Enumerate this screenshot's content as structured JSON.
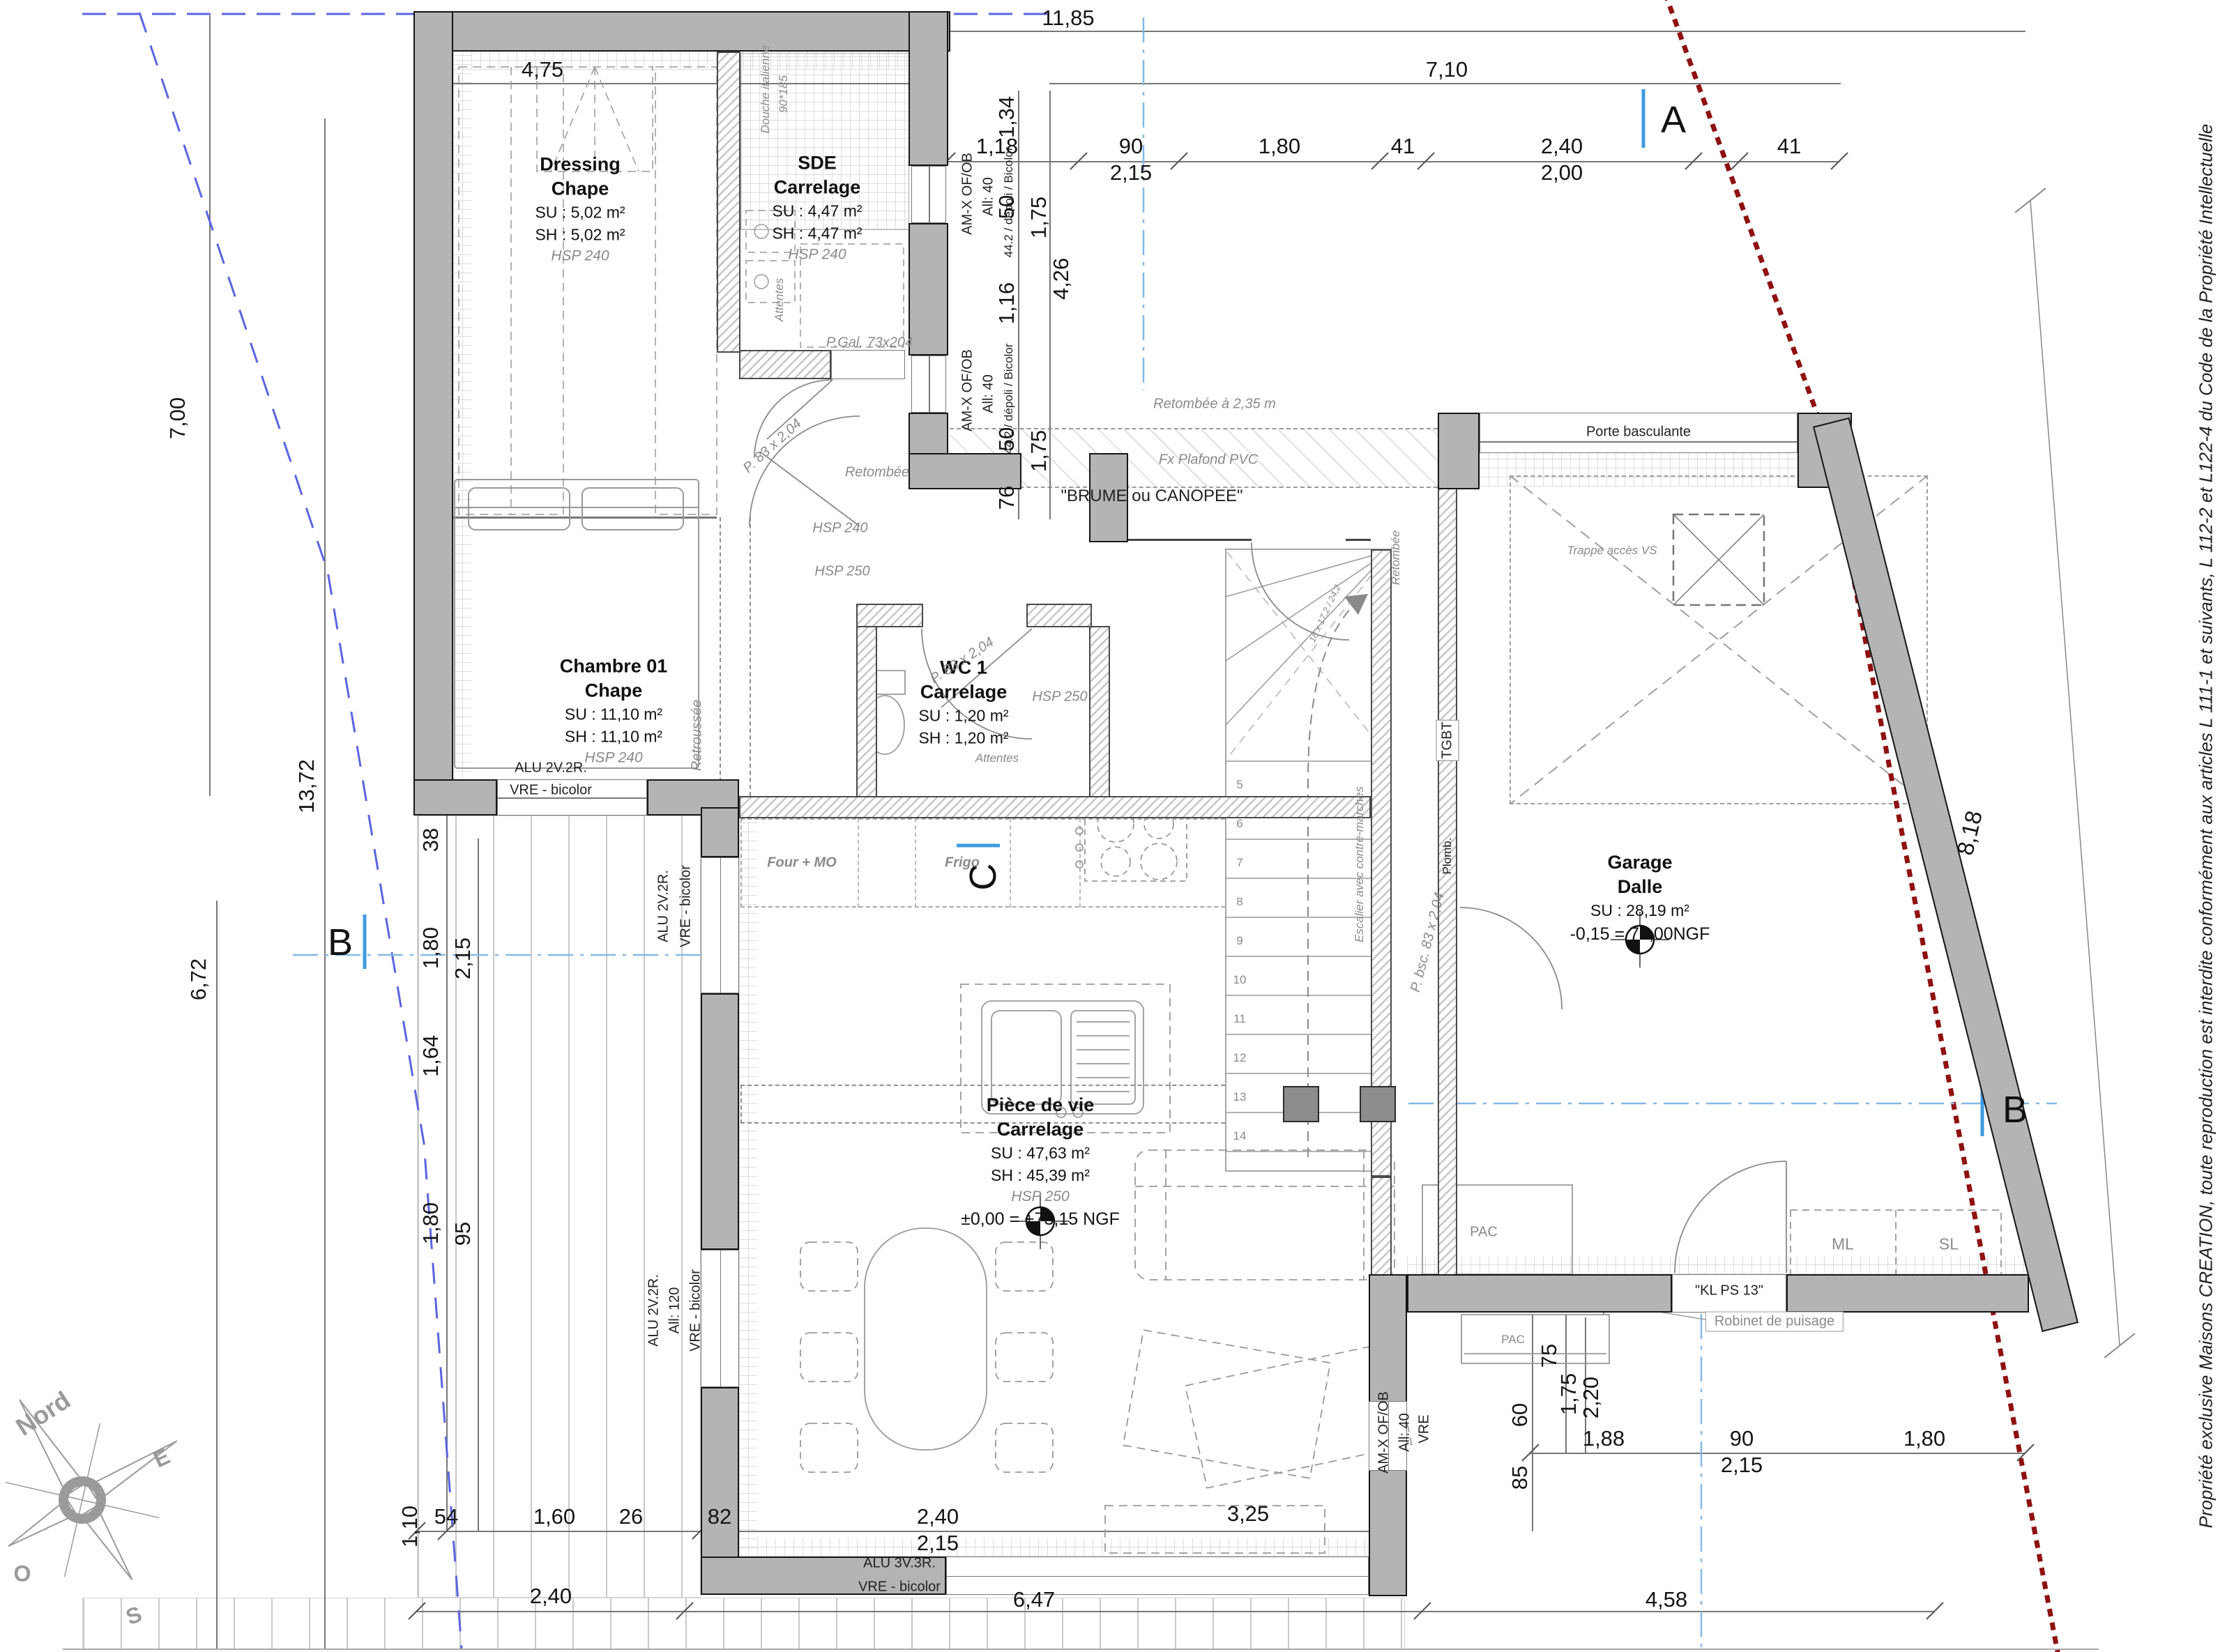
{
  "plan": {
    "copyright": "Propriété exclusive Maisons CREATION, toute reproduction est interdite conformément aux articles L 111-1 et suivants, L 112-2 et L122-4 du Code de la Propriété Intellectuelle",
    "markers": {
      "a": "A",
      "b": "B",
      "c": "C"
    },
    "compass": {
      "n": "Nord",
      "e": "E",
      "o": "O",
      "s": "S"
    },
    "rooms": {
      "dressing": {
        "name": "Dressing",
        "finish": "Chape",
        "su": "SU : 5,02 m²",
        "sh": "SH : 5,02 m²",
        "hsp": "HSP 240"
      },
      "sde": {
        "name": "SDE",
        "finish": "Carrelage",
        "su": "SU : 4,47 m²",
        "sh": "SH : 4,47 m²",
        "hsp": "HSP 240"
      },
      "chambre": {
        "name": "Chambre 01",
        "finish": "Chape",
        "su": "SU : 11,10 m²",
        "sh": "SH : 11,10 m²",
        "hsp": "HSP 240"
      },
      "wc": {
        "name": "WC 1",
        "finish": "Carrelage",
        "su": "SU : 1,20 m²",
        "sh": "SH : 1,20 m²",
        "hsp": "HSP 250"
      },
      "piece": {
        "name": "Pièce de vie",
        "finish": "Carrelage",
        "su": "SU : 47,63 m²",
        "sh": "SH : 45,39 m²",
        "hsp": "HSP 250",
        "level": "±0,00 = +73,15 NGF"
      },
      "garage": {
        "name": "Garage",
        "finish": "Dalle",
        "su": "SU : 28,19 m²",
        "level": "-0,15 = 73,00NGF"
      }
    },
    "ann": {
      "douche1": "Douche italienne",
      "douche2": "90*185",
      "attentes": "Attentes",
      "retroussee": "Retroussée",
      "pgal": "P.Gal. 73x204",
      "p83": "P. 83 x 2,04",
      "pbsc": "P. bsc. 83 x 2,04",
      "amx": "AM-X OF/OB",
      "all40": "All: 40",
      "depoli": "44.2 / dépoli / Bicolor",
      "vre": "VRE",
      "alu2": "ALU 2V.2R.",
      "vrebic": "VRE - bicolor",
      "all120": "All: 120",
      "alu3": "ALU 3V.3R.",
      "retombee": "Retombée",
      "retombee235": "Retombée à 2,35 m",
      "fxplafond": "Fx Plafond PVC",
      "brume": "\"BRUME ou CANOPEE\"",
      "hsp240": "HSP 240",
      "hsp250": "HSP 250",
      "porte_basc": "Porte basculante",
      "trappe": "Trappe accès VS",
      "tgbt": "TGBT",
      "plomb": "Plomb.",
      "escalier": "Escalier avec contre-marches",
      "stair_note": "18 x 17,2 / 24,2",
      "stair_nums": "5\n6\n7\n8\n9\n10\n11\n12\n13\n14",
      "four": "Four + MO",
      "frigo": "Frigo",
      "pac": "PAC",
      "ml": "ML",
      "sl": "SL",
      "klps": "\"KL PS 13\"",
      "robinet": "Robinet de puisage"
    },
    "dims": {
      "t1185": "11,85",
      "t475": "4,75",
      "t710": "7,10",
      "t118": "1,18",
      "t90": "90",
      "t215": "2,15",
      "t180": "1,80",
      "t41a": "41",
      "t240": "2,40",
      "t200": "2,00",
      "t41b": "41",
      "v134": "1,34",
      "v50a": "50",
      "v175a": "1,75",
      "v426": "4,26",
      "v116": "1,16",
      "v50b": "50",
      "v175b": "1,75",
      "v76": "76",
      "l700": "7,00",
      "l1372": "13,72",
      "l672": "6,72",
      "l38": "38",
      "l180a": "1,80",
      "l215a": "2,15",
      "l164": "1,64",
      "l180b": "1,80",
      "l95": "95",
      "b110": "1,10",
      "b54": "54",
      "b160": "1,60",
      "b26": "26",
      "b82": "82",
      "b240": "2,40",
      "b215": "2,15",
      "b325": "3,25",
      "b240l": "2,40",
      "b647": "6,47",
      "b458": "4,58",
      "r75": "75",
      "r60": "60",
      "r175": "1,75",
      "r220": "2,20",
      "r85": "85",
      "r188": "1,88",
      "r90": "90",
      "r215": "2,15",
      "r180": "1,80",
      "r818": "8,18"
    }
  }
}
